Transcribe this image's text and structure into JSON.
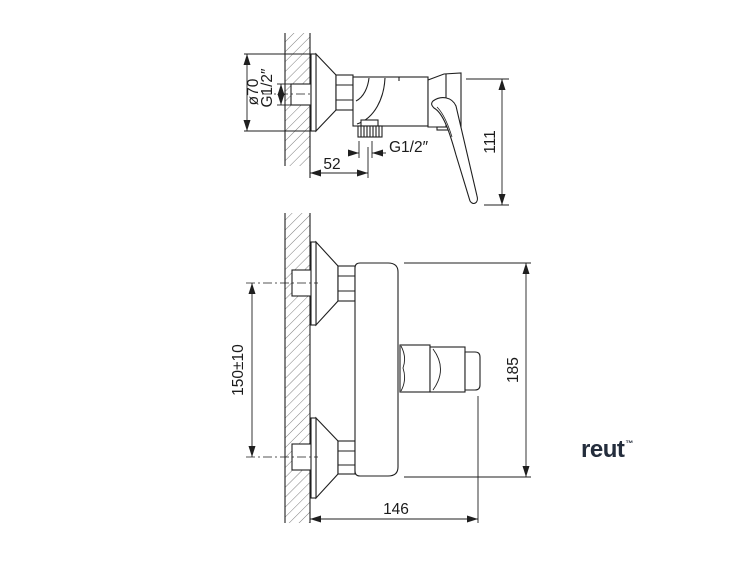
{
  "drawing": {
    "title": "wall-mounted shower mixer installation drawing",
    "line_color": "#1f1f1f",
    "side_view": {
      "dim_escutcheon_diameter": "ø70",
      "dim_inlet_thread": "G1/2″",
      "dim_outlet_thread": "G1/2″",
      "dim_wall_to_outlet": "52",
      "dim_height_with_lever": "111"
    },
    "front_view": {
      "dim_inlet_spacing": "150±10",
      "dim_overall_height": "185",
      "dim_overall_width": "146"
    },
    "logo": {
      "text": "reut",
      "mark": "™",
      "color": "#242d3c"
    }
  }
}
